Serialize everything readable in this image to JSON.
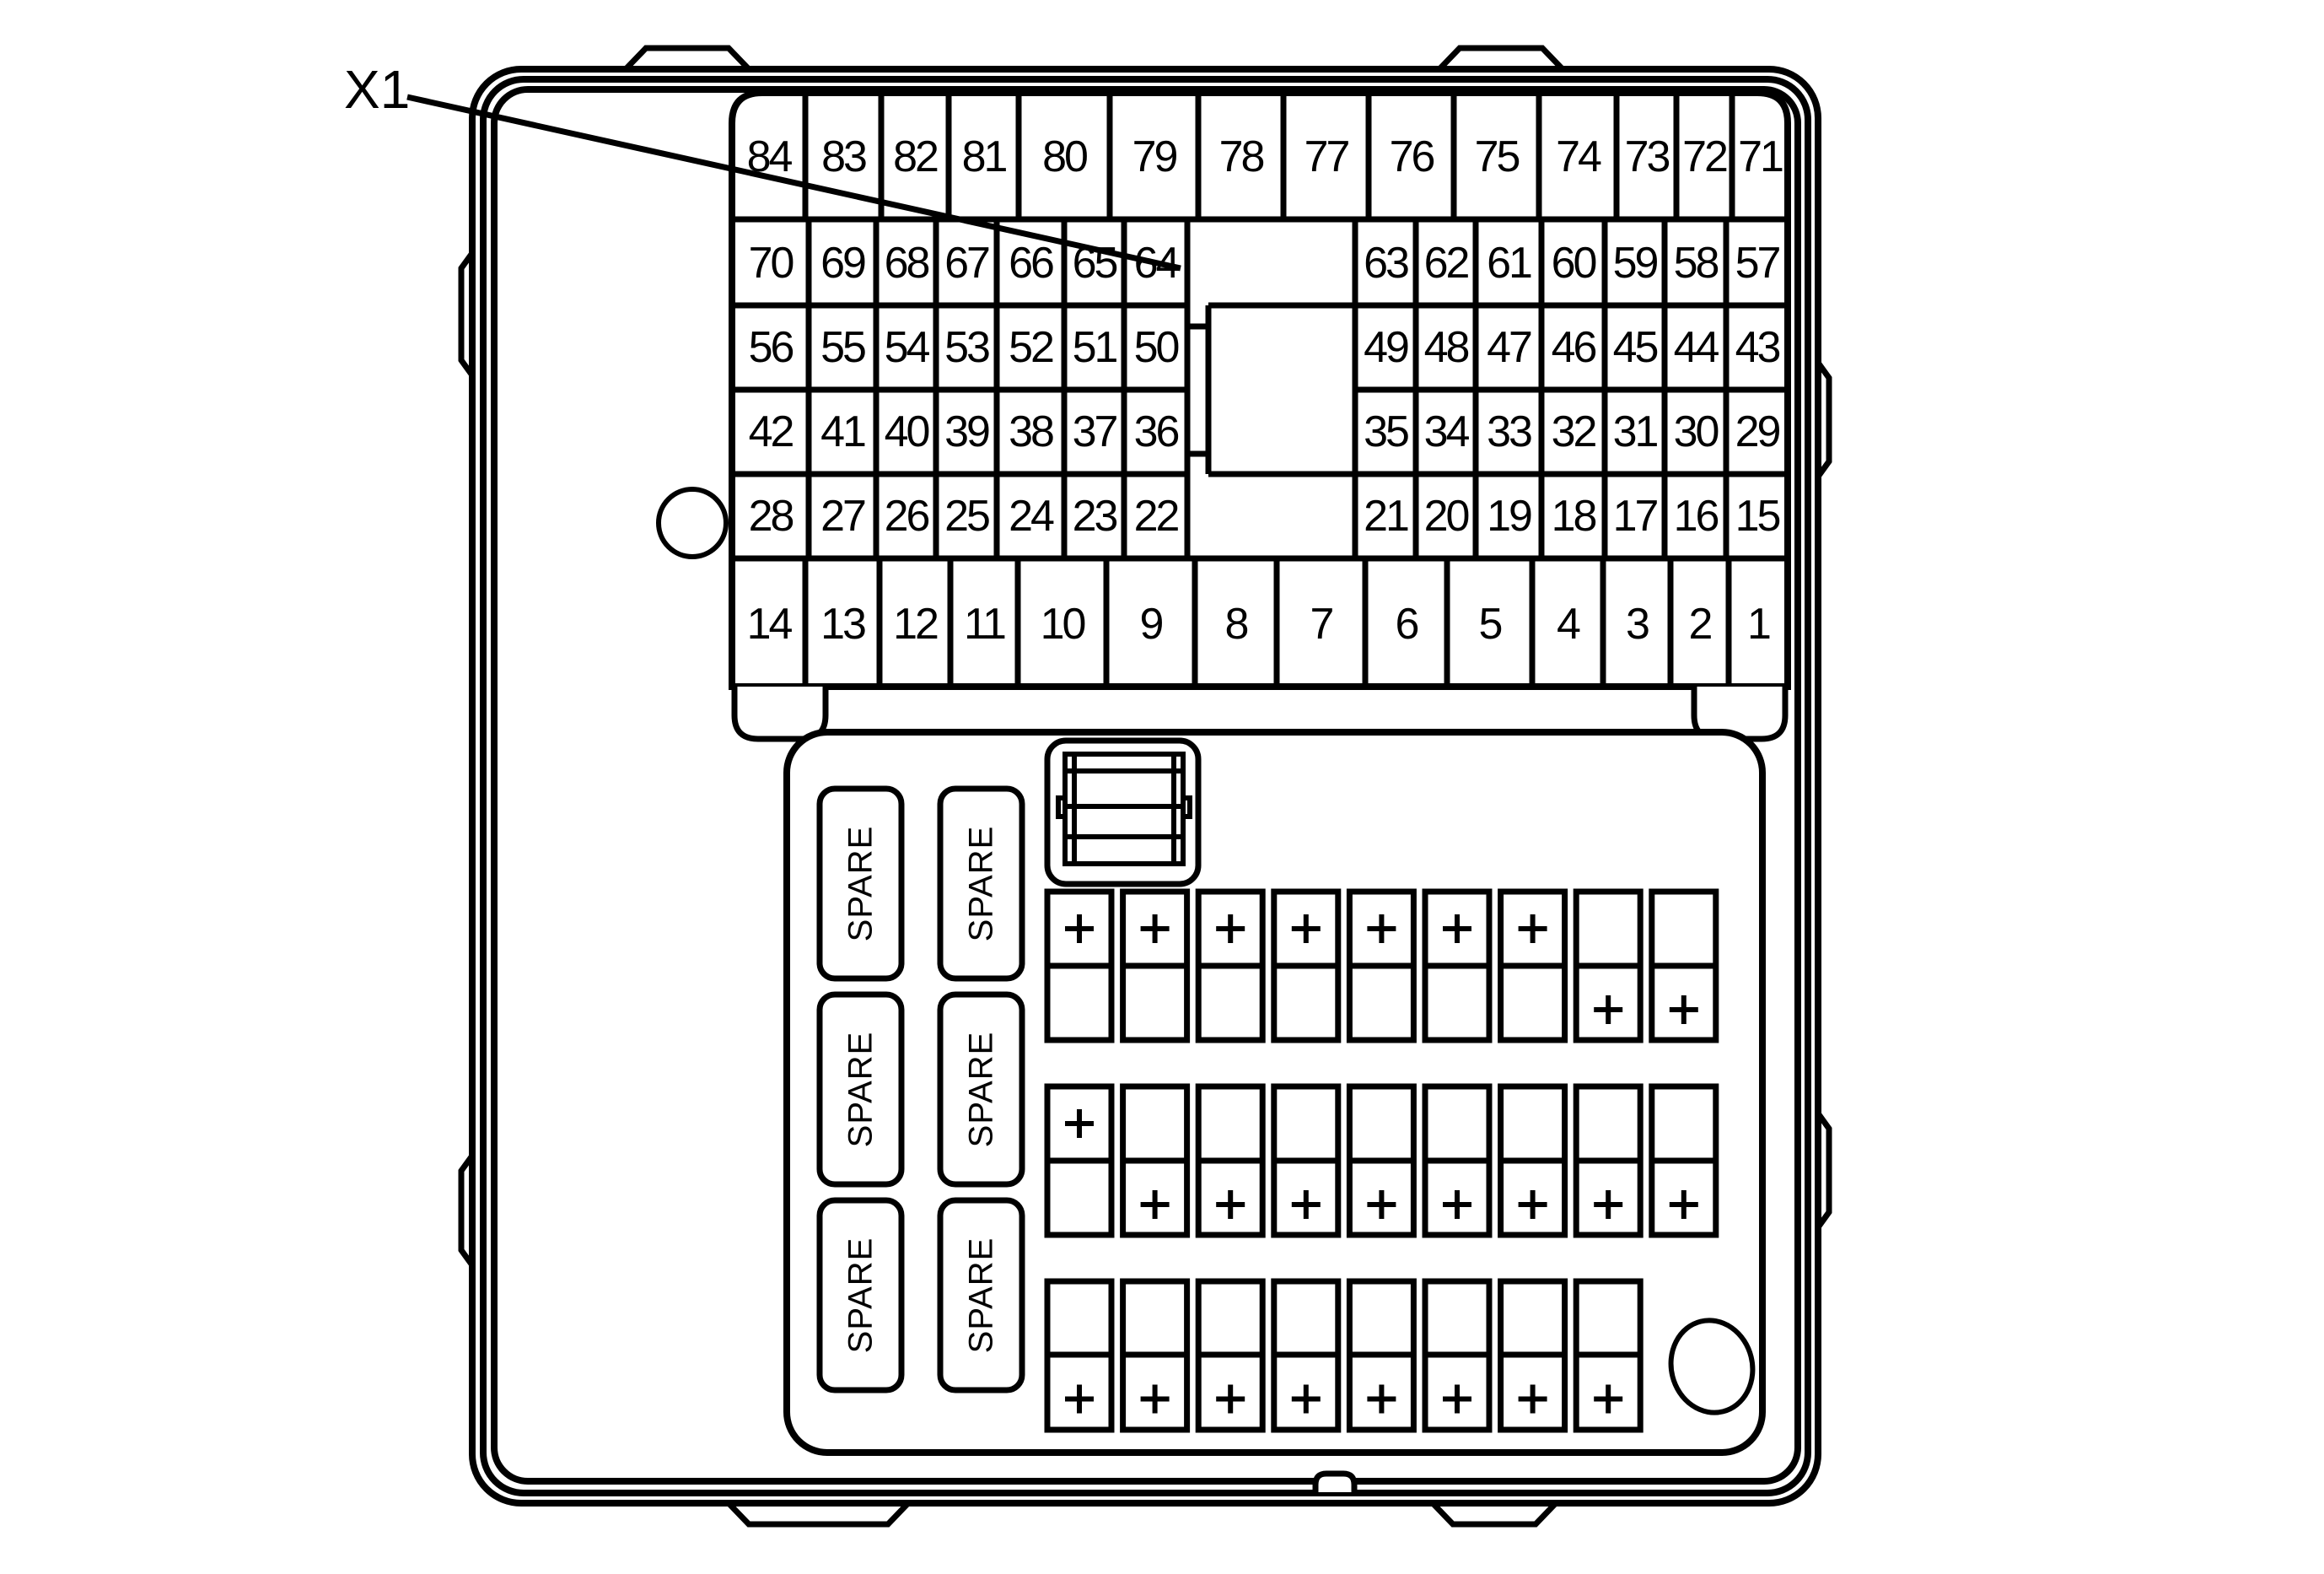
{
  "diagram_title": "Underhood fuse block top view",
  "connector": {
    "label": "X1"
  },
  "fuse_grid": {
    "row1": [
      "84",
      "83",
      "82",
      "81",
      "80",
      "79",
      "78",
      "77",
      "76",
      "75",
      "74",
      "73",
      "72",
      "71"
    ],
    "row2_left": [
      "70",
      "69",
      "68",
      "67",
      "66",
      "65",
      "64"
    ],
    "row2_right": [
      "63",
      "62",
      "61",
      "60",
      "59",
      "58",
      "57"
    ],
    "row3_left": [
      "56",
      "55",
      "54",
      "53",
      "52",
      "51",
      "50"
    ],
    "row3_right": [
      "49",
      "48",
      "47",
      "46",
      "45",
      "44",
      "43"
    ],
    "row4_left": [
      "42",
      "41",
      "40",
      "39",
      "38",
      "37",
      "36"
    ],
    "row4_right": [
      "35",
      "34",
      "33",
      "32",
      "31",
      "30",
      "29"
    ],
    "row5_left": [
      "28",
      "27",
      "26",
      "25",
      "24",
      "23",
      "22"
    ],
    "row5_right": [
      "21",
      "20",
      "19",
      "18",
      "17",
      "16",
      "15"
    ],
    "row6": [
      "14",
      "13",
      "12",
      "11",
      "10",
      "9",
      "8",
      "7",
      "6",
      "5",
      "4",
      "3",
      "2",
      "1"
    ]
  },
  "spare_fuses": {
    "label": "SPARE",
    "count": 6
  },
  "plus_symbol": "+",
  "mini_fuse_rows": [
    {
      "count": 9,
      "plus_top": [
        1,
        2,
        3,
        4,
        5,
        6,
        7
      ],
      "plus_bottom": [
        8,
        9
      ]
    },
    {
      "count": 9,
      "plus_top": [
        1
      ],
      "plus_bottom": [
        2,
        3,
        4,
        5,
        6,
        7,
        8,
        9
      ]
    },
    {
      "count": 8,
      "plus_top": [],
      "plus_bottom": [
        1,
        2,
        3,
        4,
        5,
        6,
        7,
        8
      ]
    }
  ],
  "colors": {
    "line": "#000000",
    "background": "#ffffff"
  }
}
